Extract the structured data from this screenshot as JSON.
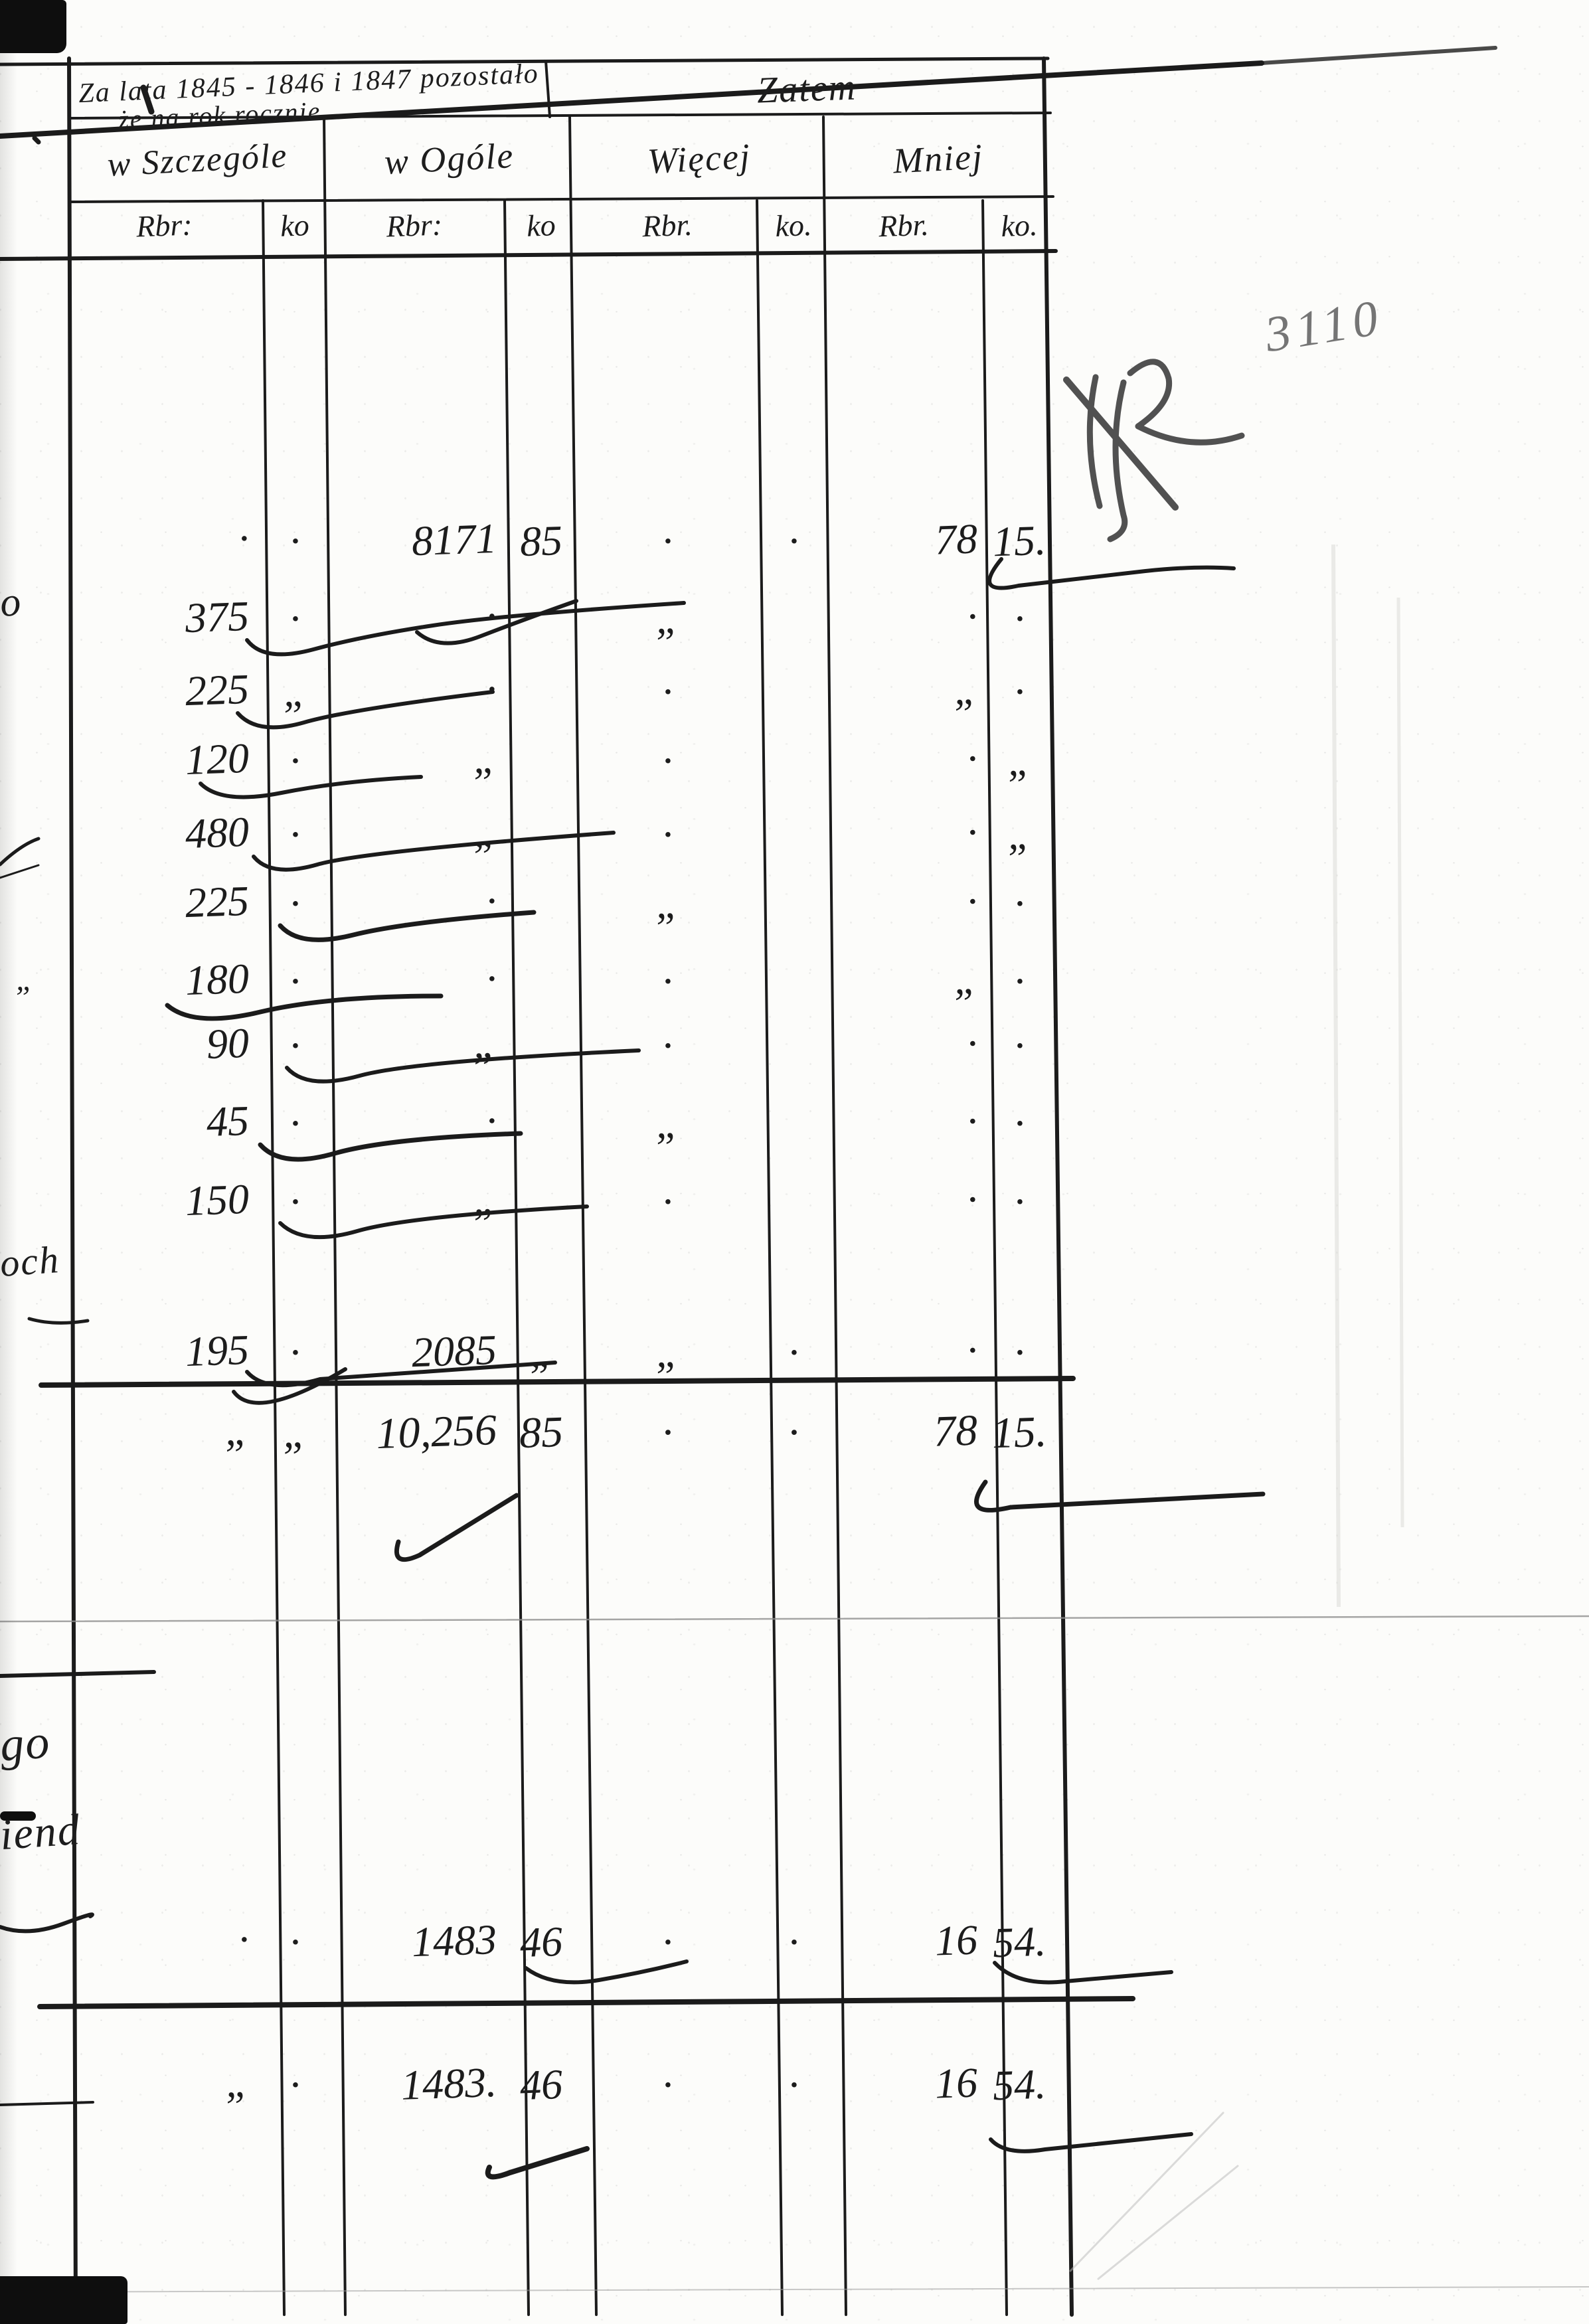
{
  "header": {
    "period_line1": "Za lata 1845 - 1846 i 1847 pozostało",
    "period_line2": "że na rok rocznie",
    "zatem": "Zatem",
    "groups": [
      "w Szczególe",
      "w Ogóle",
      "Więcej",
      "Mniej"
    ],
    "units": {
      "rbr": "Rbr:",
      "ko": "ko",
      "rbr_dot": "Rbr.",
      "ko_dot": "ko."
    }
  },
  "pencil": {
    "folio_number": "3110"
  },
  "margin_fragments": {
    "o": "o",
    "och": "och",
    "quote": "„",
    "go": "go",
    "iend": "iend"
  },
  "ledger": {
    "section1": {
      "rows": [
        {
          "sz_rbr": "·",
          "sz_ko": "·",
          "og_rbr": "8171",
          "og_ko": "85",
          "wi_rbr": "·",
          "wi_ko": "·",
          "mn_rbr": "78",
          "mn_ko": "15."
        },
        {
          "sz_rbr": "375",
          "sz_ko": "·",
          "og_rbr": "·",
          "og_ko": "",
          "wi_rbr": "„",
          "wi_ko": "",
          "mn_rbr": "·",
          "mn_ko": "·"
        },
        {
          "sz_rbr": "225",
          "sz_ko": "„",
          "og_rbr": "·",
          "og_ko": "",
          "wi_rbr": "·",
          "wi_ko": "",
          "mn_rbr": "„",
          "mn_ko": "·"
        },
        {
          "sz_rbr": "120",
          "sz_ko": "·",
          "og_rbr": "„",
          "og_ko": "",
          "wi_rbr": "·",
          "wi_ko": "",
          "mn_rbr": "·",
          "mn_ko": "„"
        },
        {
          "sz_rbr": "480",
          "sz_ko": "·",
          "og_rbr": "„",
          "og_ko": "",
          "wi_rbr": "·",
          "wi_ko": "",
          "mn_rbr": "·",
          "mn_ko": "„"
        },
        {
          "sz_rbr": "225",
          "sz_ko": "·",
          "og_rbr": "·",
          "og_ko": "",
          "wi_rbr": "„",
          "wi_ko": "",
          "mn_rbr": "·",
          "mn_ko": "·"
        },
        {
          "sz_rbr": "180",
          "sz_ko": "·",
          "og_rbr": "·",
          "og_ko": "",
          "wi_rbr": "·",
          "wi_ko": "",
          "mn_rbr": "„",
          "mn_ko": "·"
        },
        {
          "sz_rbr": "90",
          "sz_ko": "·",
          "og_rbr": "„",
          "og_ko": "",
          "wi_rbr": "·",
          "wi_ko": "",
          "mn_rbr": "·",
          "mn_ko": "·"
        },
        {
          "sz_rbr": "45",
          "sz_ko": "·",
          "og_rbr": "·",
          "og_ko": "",
          "wi_rbr": "„",
          "wi_ko": "",
          "mn_rbr": "·",
          "mn_ko": "·"
        },
        {
          "sz_rbr": "150",
          "sz_ko": "·",
          "og_rbr": "„",
          "og_ko": "",
          "wi_rbr": "·",
          "wi_ko": "",
          "mn_rbr": "·",
          "mn_ko": "·"
        },
        {
          "sz_rbr": "195",
          "sz_ko": "·",
          "og_rbr": "2085",
          "og_ko": "„",
          "wi_rbr": "„",
          "wi_ko": "·",
          "mn_rbr": "·",
          "mn_ko": "·"
        }
      ],
      "total": {
        "sz_rbr": "„",
        "sz_ko": "„",
        "og_rbr": "10,256",
        "og_ko": "85",
        "wi_rbr": "·",
        "wi_ko": "·",
        "mn_rbr": "78",
        "mn_ko": "15."
      }
    },
    "section2": {
      "rows": [
        {
          "sz_rbr": "·",
          "sz_ko": "·",
          "og_rbr": "1483",
          "og_ko": "46",
          "wi_rbr": "·",
          "wi_ko": "·",
          "mn_rbr": "16",
          "mn_ko": "54."
        }
      ],
      "total": {
        "sz_rbr": "„",
        "sz_ko": "·",
        "og_rbr": "1483.",
        "og_ko": "46",
        "wi_rbr": "·",
        "wi_ko": "·",
        "mn_rbr": "16",
        "mn_ko": "54."
      }
    }
  }
}
